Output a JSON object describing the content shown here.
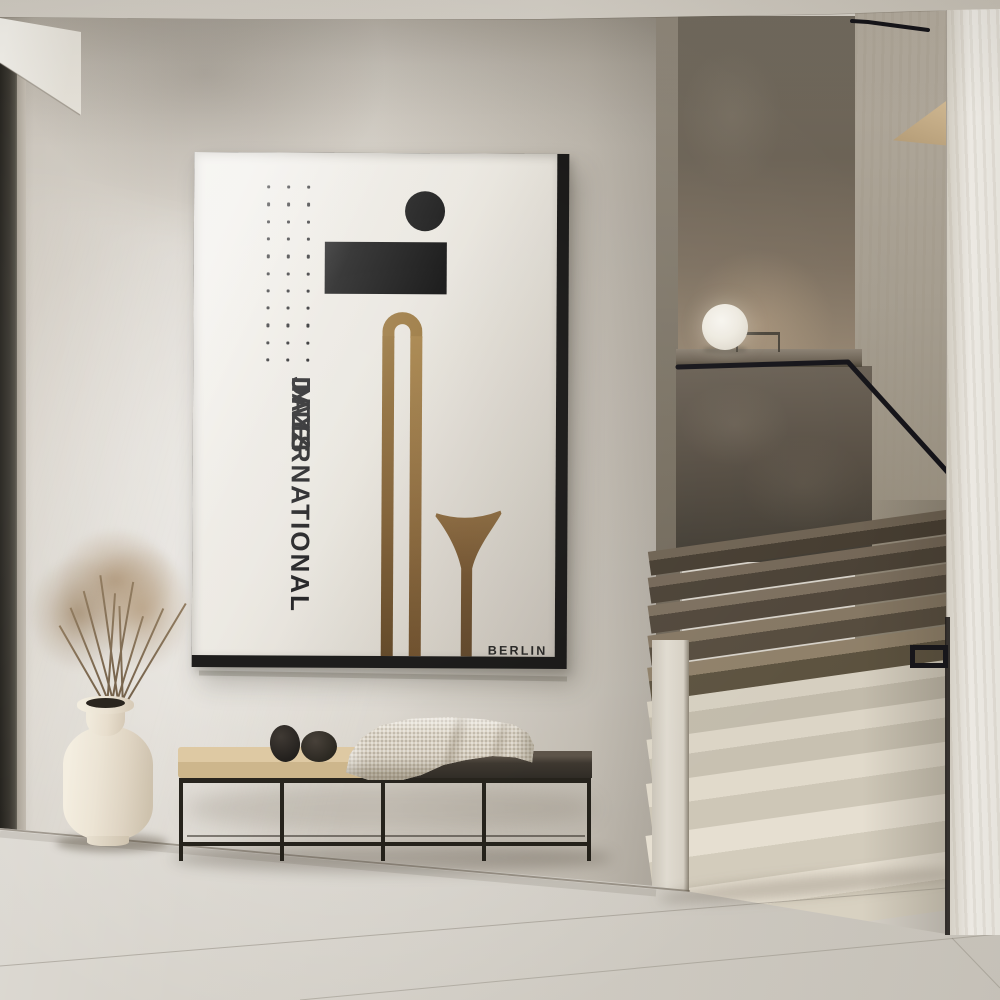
{
  "scene": {
    "description": "Minimalist concrete hallway with a framed jazz poster above a black metal bench, a cream vase with dried pampas grass, and a terrazzo staircase with black handrail and sphere lamp"
  },
  "poster": {
    "lines": [
      "INTERNATIONAL",
      "JAZZ",
      "DAYS"
    ],
    "city": "BERLIN",
    "dots": {
      "rows": 11,
      "cols": 3
    },
    "colors": {
      "background": "#e9e5de",
      "ink": "#161616",
      "gold": "#96743f",
      "frame": "#141414"
    }
  },
  "palette": {
    "wall": "#cfc9c0",
    "ceiling": "#d2cdc5",
    "floor": "#d9d6cf",
    "stair_dark_step": "#5a5145",
    "stair_light_step": "#e4decf",
    "handrail": "#15141a",
    "bench_frame": "#232019",
    "bench_cushion": "#d8c299",
    "bench_seat": "#3b352d",
    "blanket": "#d6cec0",
    "vase": "#ece4d4",
    "dried_grass": "#a98f70",
    "lamp": "#f2efe8",
    "door_frame": "#38352e"
  }
}
